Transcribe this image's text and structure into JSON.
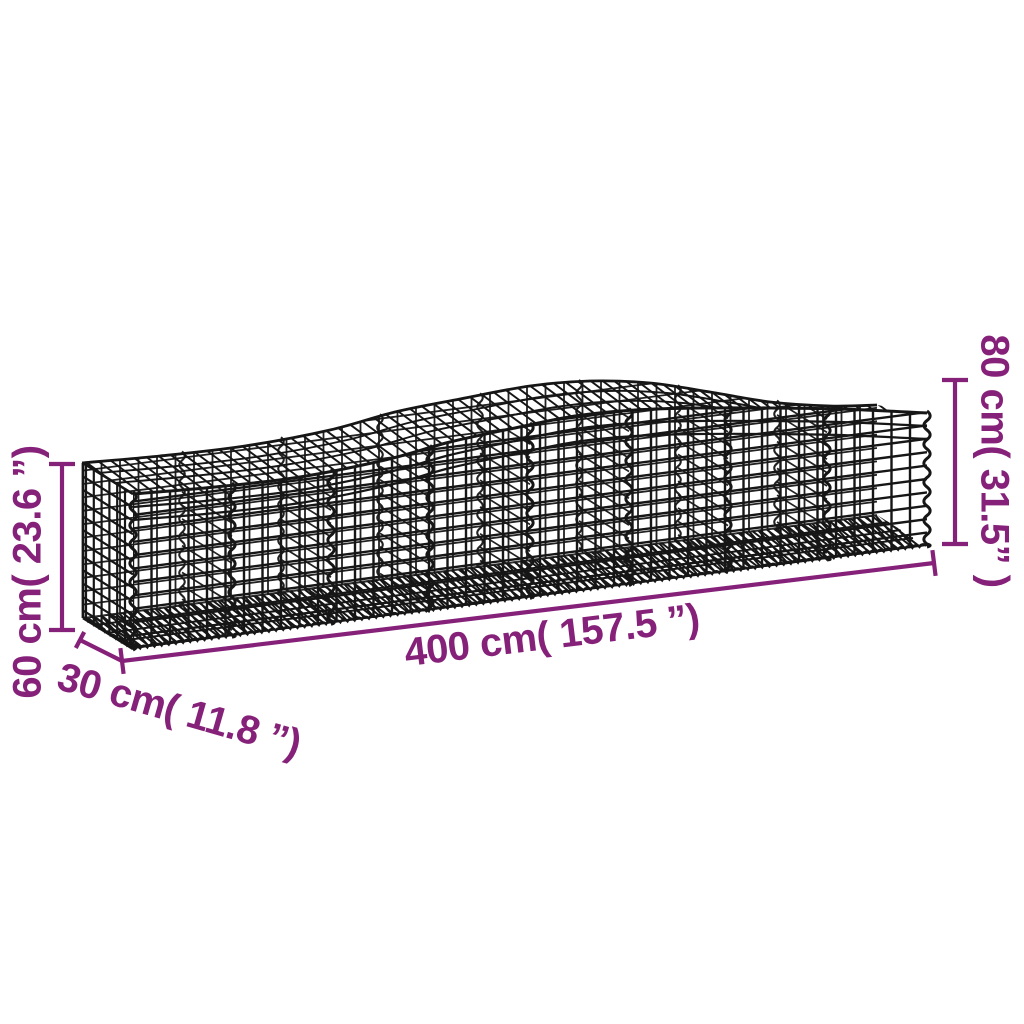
{
  "diagram": {
    "type": "product-dimension-diagram",
    "subject": "arched gabion basket of galvanised iron wire mesh",
    "colors": {
      "accent": "#86217a",
      "wire": "#161616",
      "background": "#ffffff"
    },
    "dimensions": {
      "height_end": {
        "label": "60 cm( 23.6 ”)",
        "value_cm": 60,
        "value_in": 23.6
      },
      "depth": {
        "label": "30 cm( 11.8 ”)",
        "value_cm": 30,
        "value_in": 11.8
      },
      "length": {
        "label": "400 cm( 157.5 ”)",
        "value_cm": 400,
        "value_in": 157.5
      },
      "height_peak": {
        "label": "80 cm( 31.5” )",
        "value_cm": 80,
        "value_in": 31.5
      }
    }
  }
}
